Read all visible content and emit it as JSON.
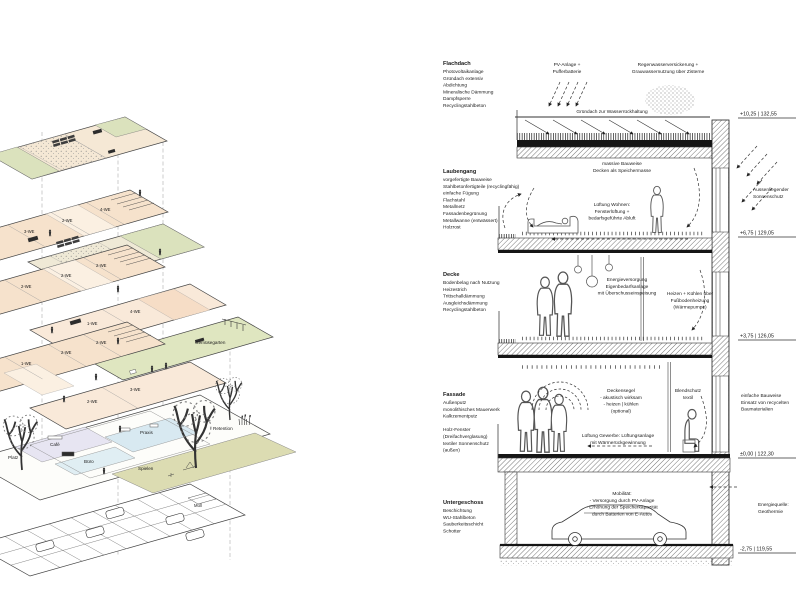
{
  "colors": {
    "green": "#dbe2bd",
    "beige": "#f5e8d5",
    "peach": "#f6ddc6",
    "lavender": "#e7e5f2",
    "blue": "#d8e9f1",
    "pale_blue": "#e0eef3",
    "olive": "#dcdcb2",
    "ink": "#1a1a1a"
  },
  "axon": {
    "p2": [
      "3-WE",
      "2-WE",
      "4-WE"
    ],
    "p4": [
      "2-WE",
      "2-WE",
      "2-WE"
    ],
    "p5": [
      "1-WE",
      "4-WE"
    ],
    "p6": "Gemüsegarten",
    "p7": [
      "1-WE",
      "2-WE",
      "2-WE"
    ],
    "p8": [
      "2-WE",
      "3-WE"
    ],
    "ground": {
      "platz": "Platz",
      "cafe": "Café",
      "praxis": "Praxis",
      "buero": "Büro",
      "spielen": "Spielen",
      "retention": "Retention"
    },
    "muell": "Müll"
  },
  "section": {
    "blocks": [
      {
        "title": "Flachdach",
        "lines": [
          "Photovoltaikanlage",
          "Gründach extensiv",
          "Abdichtung",
          "Mineralische Dämmung",
          "Dampfsperre",
          "Recyclingstahlbeton"
        ]
      },
      {
        "title": "Laubengang",
        "lines": [
          "vorgefertigte Bauweise",
          "Stahlbetonfertigteile (recyclingfähig)",
          "einfache Fügung",
          "Flachstahl",
          "Metallnetz",
          "Fassadenbegrünung",
          "Metallwanne (entwässert)",
          "Holzrost"
        ]
      },
      {
        "title": "Decke",
        "lines": [
          "Bodenbelag nach Nutzung",
          "Heizestrich",
          "Trittschalldämmung",
          "Ausgleichsdämmung",
          "Recyclingstahlbeton"
        ]
      },
      {
        "title": "Fassade",
        "lines": [
          "Außenputz",
          "monolithisches Mauerwerk",
          "Kalkzementputz",
          " ",
          "Holz-Fenster",
          "(Dreifachverglasung)",
          "textiler Sonnenschutz",
          "(außen)"
        ]
      },
      {
        "title": "Untergeschoss",
        "lines": [
          "Beschichtung",
          "WU-Stahlbeton",
          "Sauberkeitsschicht",
          "Schotter"
        ]
      }
    ],
    "top_labels": {
      "pv": [
        "PV-Anlage +",
        "Pufferbatterie"
      ],
      "rain": [
        "Regenwasserversickerung +",
        "Grauwassernutzung über Zisterne"
      ],
      "gruendach": "Gründach zur Wasserrückhaltung"
    },
    "room_notes": {
      "massive": [
        "massive Bauweise",
        "Decken als Speichermasse"
      ],
      "wohnen": [
        "Lüftung Wohnen:",
        "Fensterlüftung +",
        "bedarfsgeführte Abluft"
      ],
      "energie": [
        "Energieversorgung",
        "Eigenbedarfsanlage",
        "mit Überschusseinspeisung"
      ],
      "heizen": [
        "Heizen + Kühlen über",
        "Fußbodenheizung",
        "(Wärmepumpe)"
      ],
      "deckensegel": [
        "Deckensegel",
        "- akustisch wirksam",
        "- heizen | kühlen",
        "(optional)"
      ],
      "blendschutz": [
        "Blendschutz",
        "textil"
      ],
      "gewerbe": [
        "Lüftung Gewerbe: Lüftungsanlage",
        "mit Wärmerückgewinnung"
      ],
      "mobilitaet": [
        "Mobilität:",
        "- Versorgung durch PV-Anlage",
        "- Erhöhung der Speicherkapazität",
        "durch Batterien von E-Autos"
      ]
    },
    "side_notes": {
      "sonnenschutz": [
        "Aussenliegender",
        "Sonnenschutz"
      ],
      "einfach": [
        "einfache Bauweise",
        "Einsatz von recycelten",
        "Baumaterialien"
      ],
      "geothermie": [
        "Energiequelle:",
        "Geothermie"
      ]
    },
    "elevations": [
      "+10,25 | 132,55",
      "+6,75 | 129,05",
      "+3,75 | 126,05",
      "±0,00 | 122,30",
      "-2,75 | 119,55"
    ]
  }
}
